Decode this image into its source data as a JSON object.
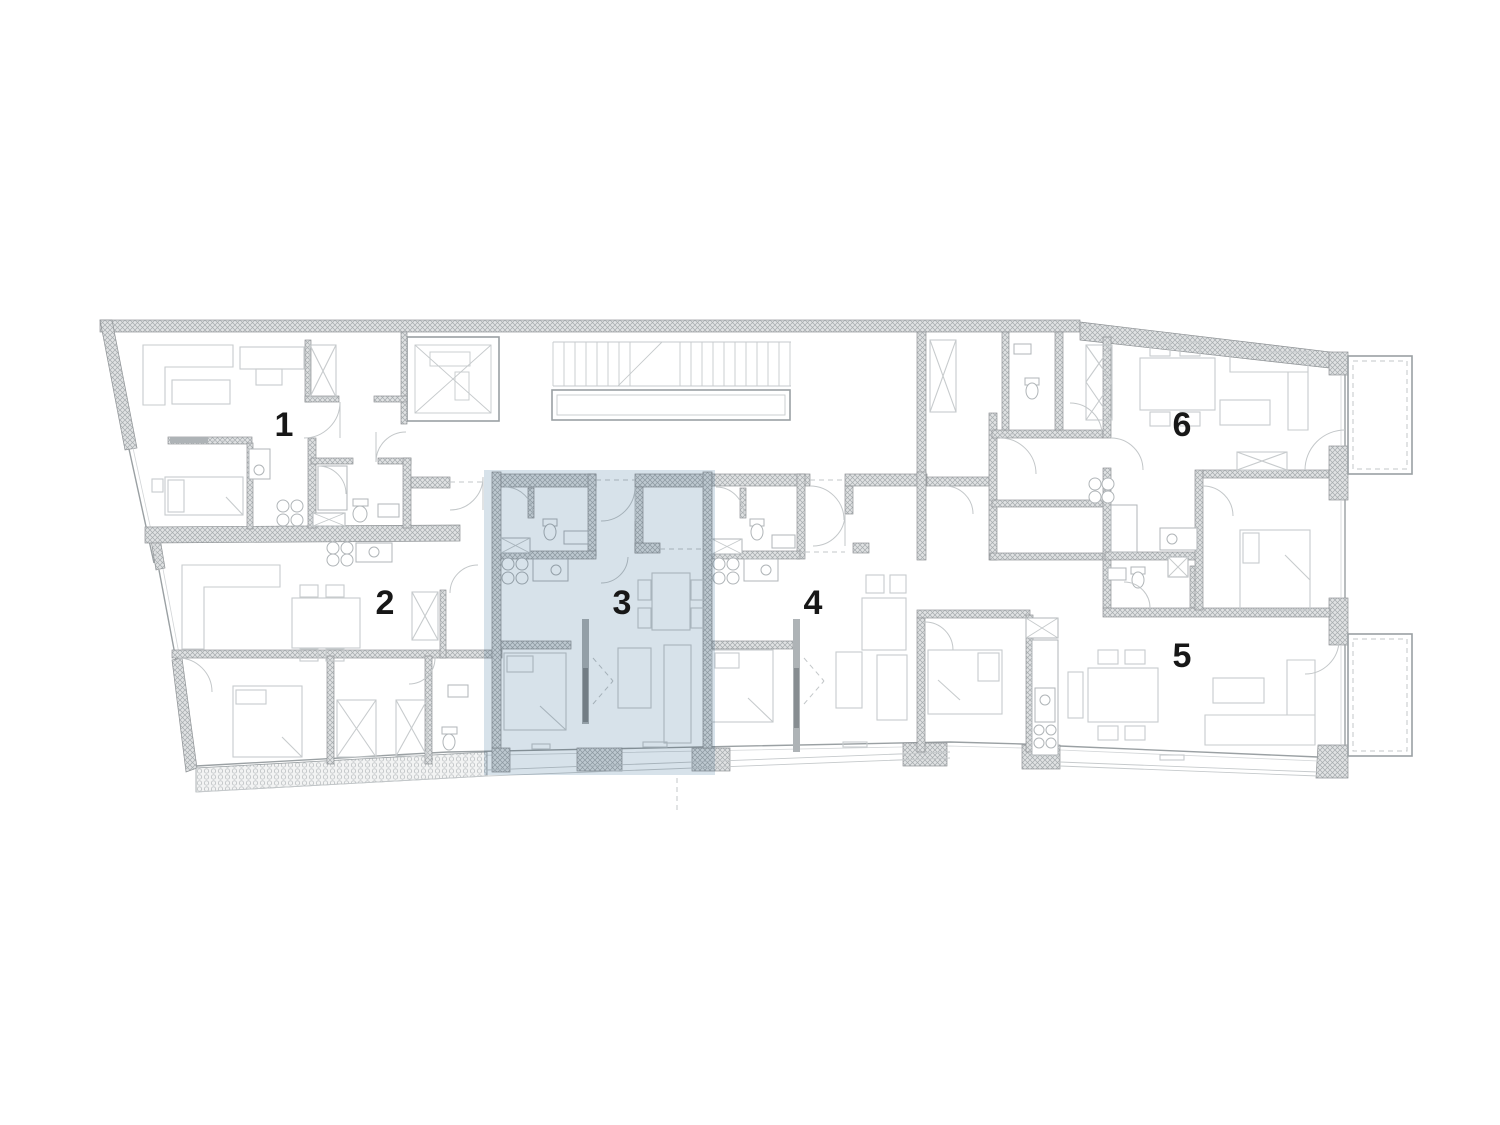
{
  "plan": {
    "kind": "apartment-floor-plan",
    "units": [
      {
        "id": "1",
        "label": "1",
        "selected": false
      },
      {
        "id": "2",
        "label": "2",
        "selected": false
      },
      {
        "id": "3",
        "label": "3",
        "selected": true
      },
      {
        "id": "4",
        "label": "4",
        "selected": false
      },
      {
        "id": "5",
        "label": "5",
        "selected": false
      },
      {
        "id": "6",
        "label": "6",
        "selected": false
      }
    ],
    "highlight": {
      "selected_unit": "3",
      "color": "#d7e2ea"
    }
  },
  "colors": {
    "background": "#ffffff",
    "wall-line": "#8f9396",
    "wall-fill": "#e0e2e3",
    "hatch-line": "#a6abae",
    "line": "#9aa0a3",
    "furniture-line": "#c7cbcd",
    "door-line": "#c3c7c9",
    "label": "#171717",
    "highlight": "#d7e2ea"
  }
}
